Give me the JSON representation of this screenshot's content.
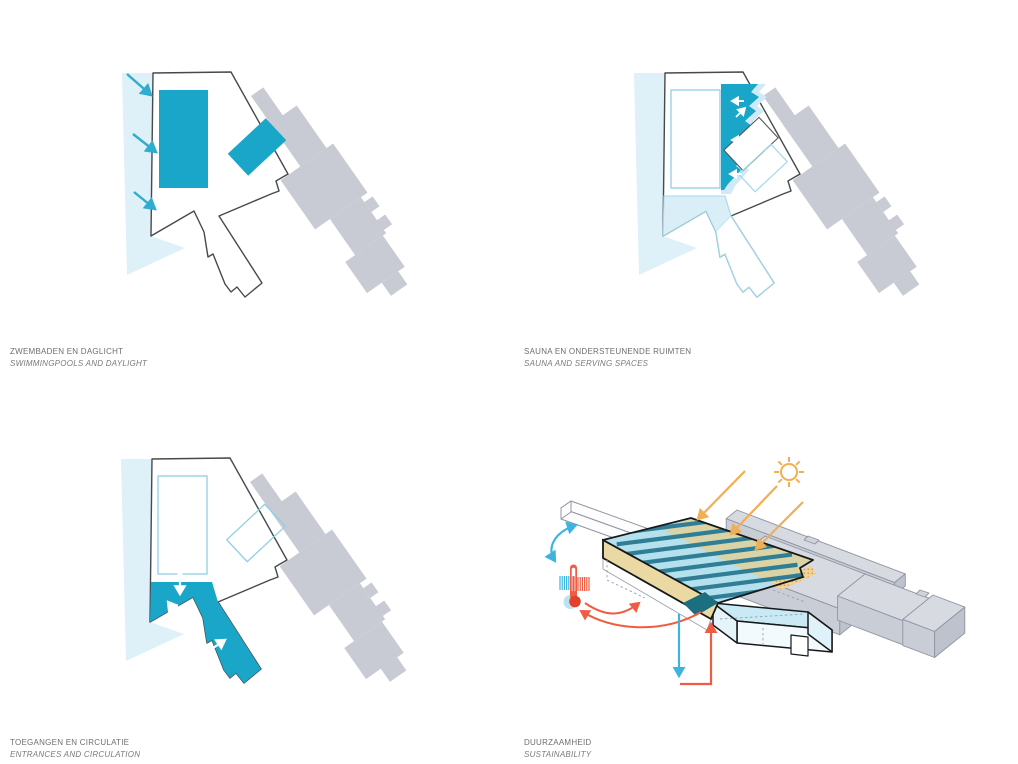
{
  "figure": {
    "type": "architecture-concept-diagram-sheet",
    "background": "#ffffff",
    "languages": "Dutch / English"
  },
  "panels": [
    {
      "id": "swimmingpools-daylight",
      "title_nl": "ZWEMBADEN EN DAGLICHT",
      "title_en": "SWIMMINGPOOLS AND DAYLIGHT",
      "diagram": "site plan: two pool areas filled teal, three daylight arrows entering from the north-west through a pale light wedge",
      "icons": [
        "daylight-arrow"
      ]
    },
    {
      "id": "sauna-serving-spaces",
      "title_nl": "SAUNA EN ONDERSTEUNENDE RUIMTEN",
      "title_en": "SAUNA AND SERVING SPACES",
      "diagram": "site plan: jagged teal sauna band along the pool hall with small white access arrows, serving spaces tinted light blue",
      "icons": [
        "access-arrow"
      ]
    },
    {
      "id": "entrances-circulation",
      "title_nl": "TOEGANGEN EN CIRCULATIE",
      "title_en": "ENTRANCES AND CIRCULATION",
      "diagram": "site plan: entrance strip and diagonal circulation spine filled teal with white double-headed flow arrows",
      "icons": [
        "flow-arrow"
      ]
    },
    {
      "id": "sustainability",
      "title_nl": "DUURZAAMHEID",
      "title_en": "SUSTAINABILITY",
      "diagram": "axonometric of the pool hall: sun with solar-gain arrows on sand-tinted roof with dark roof beams, thermometer with cool/heat flows, water drain and heat-return loop, neighbouring grey volumes",
      "icons": [
        "sun-icon",
        "solar-gain-arrow",
        "thermometer-icon",
        "cool-air-arrow",
        "heat-exchange-arrow",
        "drain-arrow",
        "heat-return-arrow"
      ]
    }
  ],
  "colors": {
    "teal": "#19a6c9",
    "pale_blue": "#def0f8",
    "pale_stroke": "#a3d9e9",
    "plan_gray": "#c8cbd4",
    "plan_outline": "#46494d",
    "caption_text": "#6e6e6e",
    "sun_orange": "#f2ae52",
    "heat_red": "#f05c43",
    "cool_blue": "#3cb4de",
    "roof_blue": "#b5e0ee",
    "roof_beam": "#2f7e95",
    "sand": "#ead9a2"
  }
}
